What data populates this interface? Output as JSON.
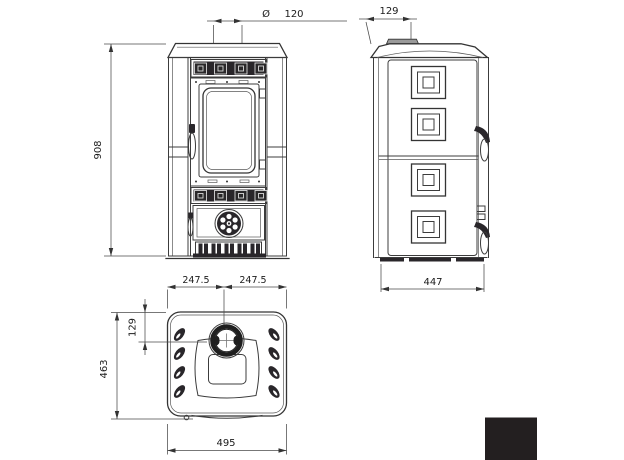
{
  "views": {
    "front": {
      "flue_diameter_symbol": "Ø",
      "flue_diameter_value": "120",
      "height": "908"
    },
    "side": {
      "flue_offset": "129",
      "depth": "447"
    },
    "top": {
      "half_width_left": "247.5",
      "half_width_right": "247.5",
      "flue_center_offset": "129",
      "depth": "463",
      "width": "495"
    }
  },
  "finish_swatch": {
    "color_hex": "#231f20"
  }
}
